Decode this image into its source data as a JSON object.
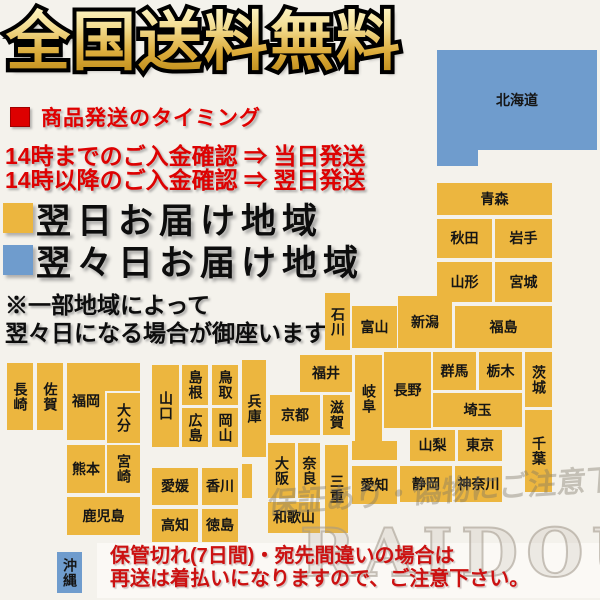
{
  "title": {
    "text": "全国送料無料"
  },
  "shipping_section": {
    "heading": "商品発送のタイミング",
    "line1": "14時までのご入金確認 ⇒ 当日発送",
    "line2": "14時以降のご入金確認 ⇒ 翌日発送"
  },
  "legend": [
    {
      "label": "翌日お届け地域",
      "color": "#ecb63f"
    },
    {
      "label": "翌々日お届け地域",
      "color": "#6f9ccd"
    }
  ],
  "note": {
    "line1": "※一部地域によって",
    "line2": "翌々日になる場合が御座います"
  },
  "watermarks": {
    "jp": "保証あり・偽物にご注意下さい",
    "brand": "RAIDOU"
  },
  "footer": {
    "line1": "保管切れ(7日間)・宛先間違いの場合は",
    "line2": "再送は着払いになりますので、ご注意下さい。"
  },
  "map": {
    "colors": {
      "next_day": "#ecb63f",
      "two_day": "#6f9ccd"
    },
    "blocks": [
      {
        "label": "北海道",
        "x": 437,
        "y": 50,
        "w": 160,
        "h": 100,
        "color": "two_day",
        "dir": "h"
      },
      {
        "label": "",
        "x": 437,
        "y": 150,
        "w": 41,
        "h": 16,
        "color": "two_day",
        "dir": "h"
      },
      {
        "label": "青森",
        "x": 437,
        "y": 183,
        "w": 115,
        "h": 32,
        "color": "next_day",
        "dir": "h"
      },
      {
        "label": "秋田",
        "x": 437,
        "y": 219,
        "w": 55,
        "h": 39,
        "color": "next_day",
        "dir": "h"
      },
      {
        "label": "岩手",
        "x": 495,
        "y": 219,
        "w": 57,
        "h": 39,
        "color": "next_day",
        "dir": "h"
      },
      {
        "label": "山形",
        "x": 437,
        "y": 262,
        "w": 55,
        "h": 40,
        "color": "next_day",
        "dir": "h"
      },
      {
        "label": "宮城",
        "x": 495,
        "y": 262,
        "w": 57,
        "h": 40,
        "color": "next_day",
        "dir": "h"
      },
      {
        "label": "新潟",
        "x": 398,
        "y": 296,
        "w": 54,
        "h": 52,
        "color": "next_day",
        "dir": "h"
      },
      {
        "label": "福島",
        "x": 455,
        "y": 306,
        "w": 97,
        "h": 42,
        "color": "next_day",
        "dir": "h"
      },
      {
        "label": "石川",
        "x": 325,
        "y": 293,
        "w": 25,
        "h": 57,
        "color": "next_day",
        "dir": "v"
      },
      {
        "label": "富山",
        "x": 352,
        "y": 306,
        "w": 45,
        "h": 42,
        "color": "next_day",
        "dir": "h"
      },
      {
        "label": "福井",
        "x": 300,
        "y": 355,
        "w": 52,
        "h": 37,
        "color": "next_day",
        "dir": "h"
      },
      {
        "label": "岐阜",
        "x": 355,
        "y": 355,
        "w": 27,
        "h": 88,
        "color": "next_day",
        "dir": "v"
      },
      {
        "label": "",
        "x": 352,
        "y": 441,
        "w": 45,
        "h": 19,
        "color": "next_day",
        "dir": "h"
      },
      {
        "label": "長野",
        "x": 384,
        "y": 352,
        "w": 47,
        "h": 76,
        "color": "next_day",
        "dir": "h"
      },
      {
        "label": "群馬",
        "x": 433,
        "y": 352,
        "w": 43,
        "h": 38,
        "color": "next_day",
        "dir": "h"
      },
      {
        "label": "栃木",
        "x": 479,
        "y": 352,
        "w": 43,
        "h": 38,
        "color": "next_day",
        "dir": "h"
      },
      {
        "label": "茨城",
        "x": 525,
        "y": 352,
        "w": 27,
        "h": 55,
        "color": "next_day",
        "dir": "v"
      },
      {
        "label": "埼玉",
        "x": 433,
        "y": 393,
        "w": 89,
        "h": 34,
        "color": "next_day",
        "dir": "h"
      },
      {
        "label": "山梨",
        "x": 410,
        "y": 430,
        "w": 45,
        "h": 31,
        "color": "next_day",
        "dir": "h"
      },
      {
        "label": "東京",
        "x": 458,
        "y": 430,
        "w": 44,
        "h": 31,
        "color": "next_day",
        "dir": "h"
      },
      {
        "label": "千葉",
        "x": 525,
        "y": 410,
        "w": 27,
        "h": 82,
        "color": "next_day",
        "dir": "v"
      },
      {
        "label": "神奈川",
        "x": 455,
        "y": 466,
        "w": 47,
        "h": 36,
        "color": "next_day",
        "dir": "h"
      },
      {
        "label": "静岡",
        "x": 400,
        "y": 466,
        "w": 52,
        "h": 36,
        "color": "next_day",
        "dir": "h"
      },
      {
        "label": "愛知",
        "x": 352,
        "y": 466,
        "w": 45,
        "h": 38,
        "color": "next_day",
        "dir": "h"
      },
      {
        "label": "滋賀",
        "x": 323,
        "y": 395,
        "w": 27,
        "h": 40,
        "color": "next_day",
        "dir": "v"
      },
      {
        "label": "京都",
        "x": 270,
        "y": 395,
        "w": 50,
        "h": 40,
        "color": "next_day",
        "dir": "h"
      },
      {
        "label": "兵庫",
        "x": 242,
        "y": 360,
        "w": 24,
        "h": 97,
        "color": "next_day",
        "dir": "v"
      },
      {
        "label": "",
        "x": 242,
        "y": 464,
        "w": 10,
        "h": 34,
        "color": "next_day",
        "dir": "h"
      },
      {
        "label": "大阪",
        "x": 268,
        "y": 443,
        "w": 27,
        "h": 55,
        "color": "next_day",
        "dir": "v"
      },
      {
        "label": "奈良",
        "x": 298,
        "y": 443,
        "w": 22,
        "h": 55,
        "color": "next_day",
        "dir": "v"
      },
      {
        "label": "三重",
        "x": 325,
        "y": 445,
        "w": 23,
        "h": 88,
        "color": "next_day",
        "dir": "v"
      },
      {
        "label": "和歌山",
        "x": 268,
        "y": 502,
        "w": 52,
        "h": 31,
        "color": "next_day",
        "dir": "h"
      },
      {
        "label": "鳥取",
        "x": 212,
        "y": 365,
        "w": 26,
        "h": 40,
        "color": "next_day",
        "dir": "v"
      },
      {
        "label": "島根",
        "x": 182,
        "y": 365,
        "w": 26,
        "h": 40,
        "color": "next_day",
        "dir": "v"
      },
      {
        "label": "岡山",
        "x": 212,
        "y": 408,
        "w": 26,
        "h": 39,
        "color": "next_day",
        "dir": "v"
      },
      {
        "label": "広島",
        "x": 182,
        "y": 408,
        "w": 26,
        "h": 39,
        "color": "next_day",
        "dir": "v"
      },
      {
        "label": "山口",
        "x": 152,
        "y": 365,
        "w": 27,
        "h": 82,
        "color": "next_day",
        "dir": "v"
      },
      {
        "label": "香川",
        "x": 202,
        "y": 468,
        "w": 36,
        "h": 37,
        "color": "next_day",
        "dir": "h"
      },
      {
        "label": "愛媛",
        "x": 152,
        "y": 468,
        "w": 46,
        "h": 37,
        "color": "next_day",
        "dir": "h"
      },
      {
        "label": "徳島",
        "x": 202,
        "y": 509,
        "w": 36,
        "h": 33,
        "color": "next_day",
        "dir": "h"
      },
      {
        "label": "高知",
        "x": 152,
        "y": 509,
        "w": 46,
        "h": 33,
        "color": "next_day",
        "dir": "h"
      },
      {
        "label": "福岡",
        "x": 67,
        "y": 363,
        "w": 38,
        "h": 77,
        "color": "next_day",
        "dir": "h"
      },
      {
        "label": "",
        "x": 103,
        "y": 363,
        "w": 37,
        "h": 28,
        "color": "next_day",
        "dir": "h"
      },
      {
        "label": "大分",
        "x": 107,
        "y": 393,
        "w": 33,
        "h": 50,
        "color": "next_day",
        "dir": "v"
      },
      {
        "label": "熊本",
        "x": 67,
        "y": 445,
        "w": 38,
        "h": 48,
        "color": "next_day",
        "dir": "h"
      },
      {
        "label": "宮崎",
        "x": 107,
        "y": 445,
        "w": 33,
        "h": 48,
        "color": "next_day",
        "dir": "v"
      },
      {
        "label": "鹿児島",
        "x": 67,
        "y": 497,
        "w": 73,
        "h": 38,
        "color": "next_day",
        "dir": "h"
      },
      {
        "label": "長崎",
        "x": 7,
        "y": 363,
        "w": 26,
        "h": 67,
        "color": "next_day",
        "dir": "v"
      },
      {
        "label": "佐賀",
        "x": 37,
        "y": 363,
        "w": 26,
        "h": 67,
        "color": "next_day",
        "dir": "v"
      },
      {
        "label": "沖縄",
        "x": 57,
        "y": 552,
        "w": 25,
        "h": 41,
        "color": "two_day",
        "dir": "v"
      }
    ]
  }
}
